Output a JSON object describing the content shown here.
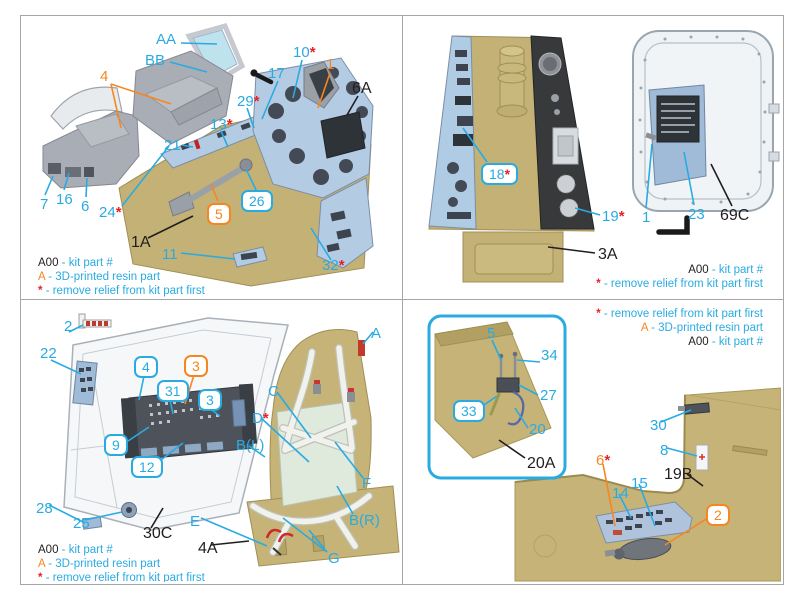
{
  "legend": {
    "kit_code": "A00",
    "kit_desc": "- kit part #",
    "resin_code": "A",
    "resin_desc": "- 3D-printed resin part",
    "star_code": "*",
    "star_desc": "- remove relief from kit part first"
  },
  "colors": {
    "callout_cyan": "#29ABE2",
    "callout_orange": "#F6861F",
    "star_red": "#E8202A",
    "kit_black": "#221E1F",
    "kit_plastic_tan": "#C4B175",
    "decal_panel_blue": "#B3CCE4",
    "resin_gray": "#A9ADB5"
  },
  "q": {
    "tl": {
      "c": [
        "AA",
        "BB",
        "4",
        "10",
        "1",
        "17",
        "6A",
        "29",
        "13",
        "21",
        "26",
        "5",
        "24",
        "7",
        "16",
        "6",
        "1A",
        "11",
        "32"
      ]
    },
    "tr": {
      "c": [
        "18",
        "19",
        "3A",
        "1",
        "23",
        "69C"
      ]
    },
    "bl": {
      "c": [
        "2",
        "22",
        "4",
        "3",
        "31",
        "3",
        "9",
        "12",
        "28",
        "25",
        "30C",
        "A",
        "C",
        "D",
        "B(L)",
        "F",
        "B(R)",
        "E",
        "4A",
        "G"
      ]
    },
    "br": {
      "c": [
        "5",
        "34",
        "27",
        "33",
        "20",
        "20A",
        "30",
        "8",
        "6",
        "14",
        "15",
        "19B",
        "2"
      ]
    }
  }
}
